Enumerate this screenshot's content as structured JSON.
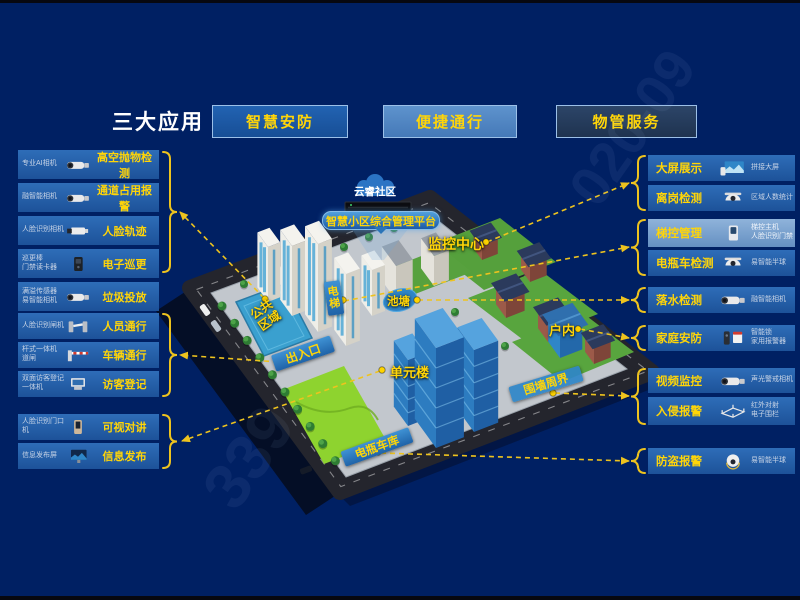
{
  "title": "三大应用",
  "apps": [
    {
      "label": "智慧安防"
    },
    {
      "label": "便捷通行"
    },
    {
      "label": "物管服务"
    }
  ],
  "left_features": [
    {
      "device": "专业AI相机",
      "label": "高空抛物检测"
    },
    {
      "device": "融智能相机",
      "label": "通道占用报警"
    },
    {
      "device": "人脸识别相机",
      "label": "人脸轨迹"
    },
    {
      "device": "巡更棒\n门禁读卡器",
      "label": "电子巡更"
    },
    {
      "device": "满溢传感器\n易智能相机",
      "label": "垃圾投放"
    },
    {
      "device": "人脸识别闸机",
      "label": "人员通行"
    },
    {
      "device": "杆式一体机\n道闸",
      "label": "车辆通行"
    },
    {
      "device": "双面访客登记\n一体机",
      "label": "访客登记"
    },
    {
      "device": "人脸识别门口机",
      "label": "可视对讲"
    },
    {
      "device": "信息发布屏",
      "label": "信息发布"
    }
  ],
  "right_features": [
    {
      "label": "大屏展示",
      "device": "拼接大屏"
    },
    {
      "label": "离岗检测",
      "device": "区域人数统计"
    },
    {
      "label": "梯控管理",
      "device": "梯控主机\n人脸识别门禁"
    },
    {
      "label": "电瓶车检测",
      "device": "易智能半球"
    },
    {
      "label": "落水检测",
      "device": "融智能相机"
    },
    {
      "label": "家庭安防",
      "device": "智能锁\n家用报警器"
    },
    {
      "label": "视频监控",
      "device": "声光警戒相机"
    },
    {
      "label": "入侵报警",
      "device": "红外对射\n电子围栏"
    },
    {
      "label": "防盗报警",
      "device": "易智能半球"
    }
  ],
  "map": {
    "cloud": "云睿社区",
    "platform": "智慧小区综合管理平台",
    "zones": {
      "monitor_center": "监控中心",
      "elevator": "电梯",
      "pond": "池塘",
      "public_area": "公共区域",
      "entrance": "出入口",
      "unit_building": "单元楼",
      "indoor": "户内",
      "perimeter": "围墙周界",
      "bike_garage": "电瓶车库"
    }
  },
  "watermark": {
    "wm1": "339",
    "wm2": "020-09"
  },
  "colors": {
    "background": "#002063",
    "accent_yellow": "#ffd508",
    "banner_blue": "#2f86c8"
  }
}
